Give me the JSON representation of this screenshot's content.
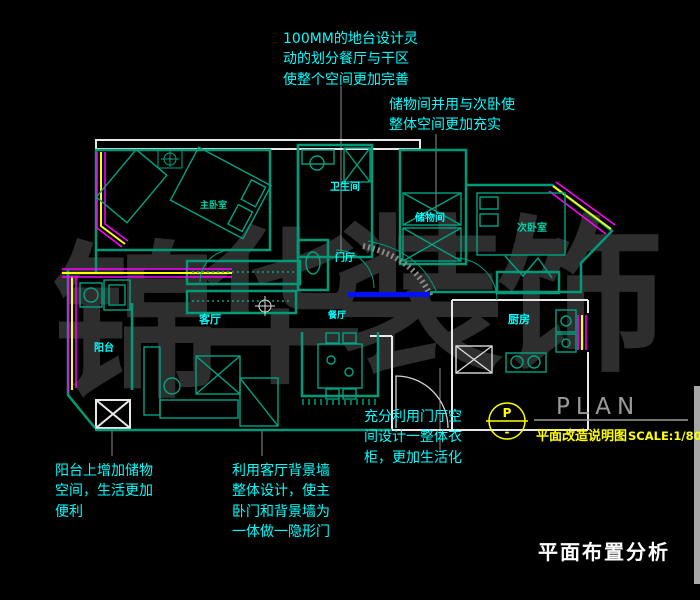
{
  "colors": {
    "background": "#000000",
    "wall_teal": "#009a78",
    "wall_white": "#e8e8e8",
    "label_cyan": "#00ffff",
    "label_teal": "#00cfa6",
    "window_yellow": "#ffff00",
    "window_magenta": "#ff00ff",
    "highlight_blue": "#0011ff",
    "watermark_gray": "#2e2e2e",
    "title_gray": "#9a9a9a",
    "text_white": "#ffffff"
  },
  "watermark": {
    "chars": [
      "锦",
      "华",
      "装",
      "饰"
    ]
  },
  "annotations": {
    "platform": "100MM的地台设计灵\n动的划分餐厅与干区\n使整个空间更加完善",
    "storage_room": "储物间并用与次卧使\n整体空间更加充实",
    "hall_wardrobe": "充分利用门厅空\n间设计一整体衣\n柜，更加生活化",
    "balcony_storage": "阳台上增加储物\n空间，生活更加\n便利",
    "living_wall": "利用客厅背景墙\n整体设计，使主\n卧门和背景墙为\n一体做一隐形门"
  },
  "rooms": {
    "master_bedroom": "主卧室",
    "bathroom": "卫生间",
    "storage": "储物间",
    "second_bedroom": "次卧室",
    "hall": "门厅",
    "dining": "餐厅",
    "living": "客厅",
    "kitchen": "厨房",
    "balcony": "阳台"
  },
  "title_block": {
    "marker_top": "P",
    "marker_bottom": "-",
    "title": "PLAN",
    "subtitle": "平面改造说明图",
    "scale": "SCALE:1/80"
  },
  "footer": {
    "title": "平面布置分析"
  }
}
